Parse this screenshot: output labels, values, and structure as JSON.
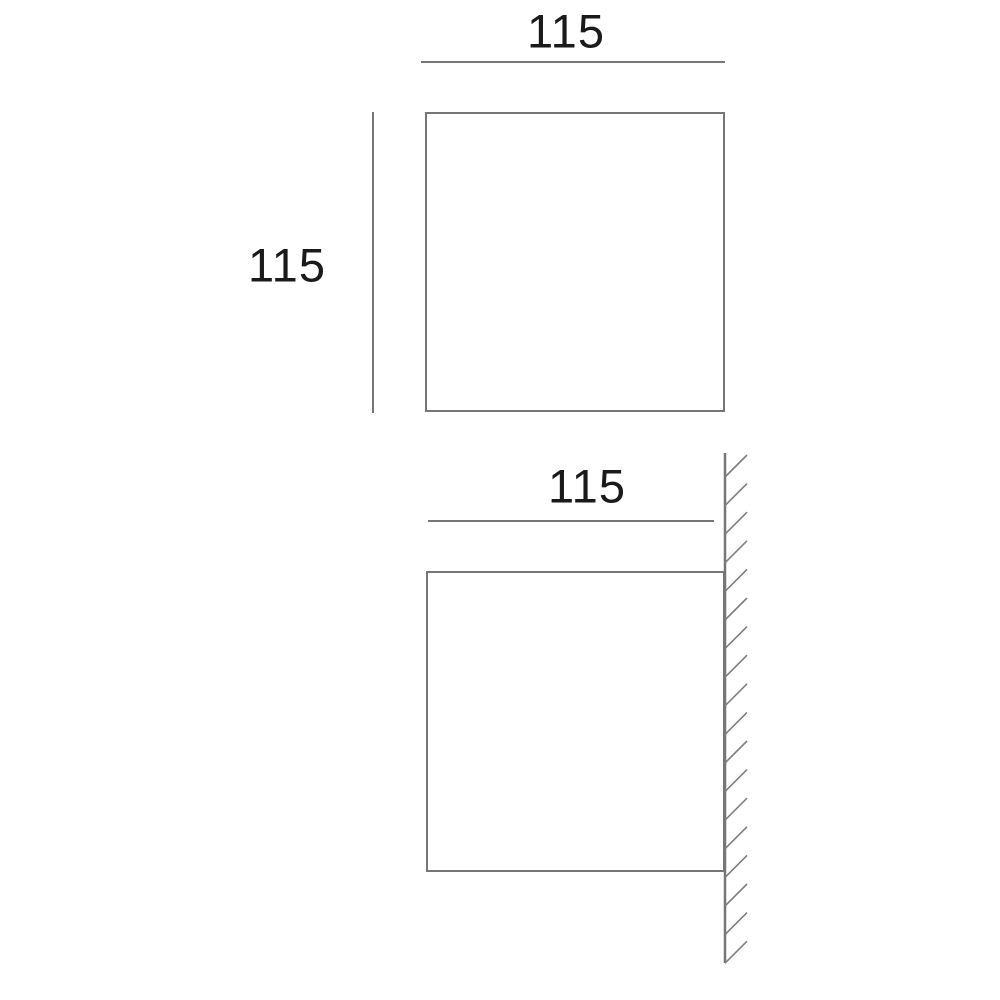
{
  "diagram": {
    "type": "product-dimension-drawing",
    "unit_note": "millimetres (implied)",
    "views": {
      "front": {
        "name": "front view",
        "width_label": "115",
        "height_label": "115"
      },
      "side": {
        "name": "side view against wall",
        "width_label": "115"
      }
    },
    "colors": {
      "line": "#767676",
      "hatch": "#7e7e7e",
      "text": "#1a1a1a",
      "background": "#ffffff"
    }
  }
}
